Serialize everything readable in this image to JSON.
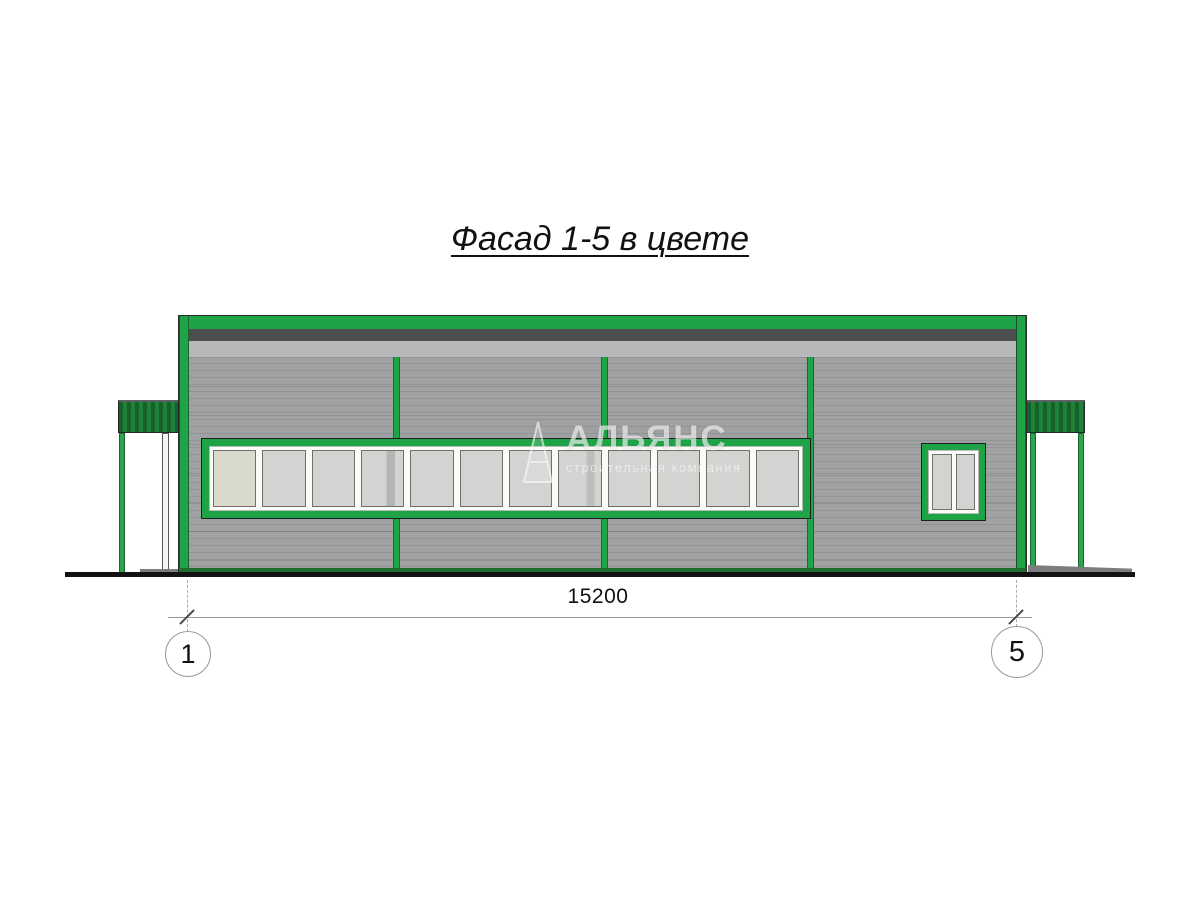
{
  "title": "Фасад 1-5 в цвете",
  "watermark": {
    "logo": "triangle-icon",
    "name": "АЛЬЯНС",
    "subtitle": "строительная компания"
  },
  "dimension": {
    "value": "15200"
  },
  "axis_markers": {
    "left": "1",
    "right": "5"
  },
  "facade": {
    "ribbon_window": {
      "panes": 12
    },
    "small_window": {
      "panes": 2
    },
    "colors": {
      "frame_green": "#1FA347",
      "canopy_dark": "#15612A",
      "canopy_mid": "#1F8038",
      "wall_gray": "#9FA1A3",
      "wall_line": "#919395",
      "fascia_dark": "#4B4D4F",
      "fascia_light": "#B6B8BA",
      "glass": "#D3D4D2",
      "glass_warm": "#D9D9CC",
      "base_green": "#1E6E30"
    }
  }
}
